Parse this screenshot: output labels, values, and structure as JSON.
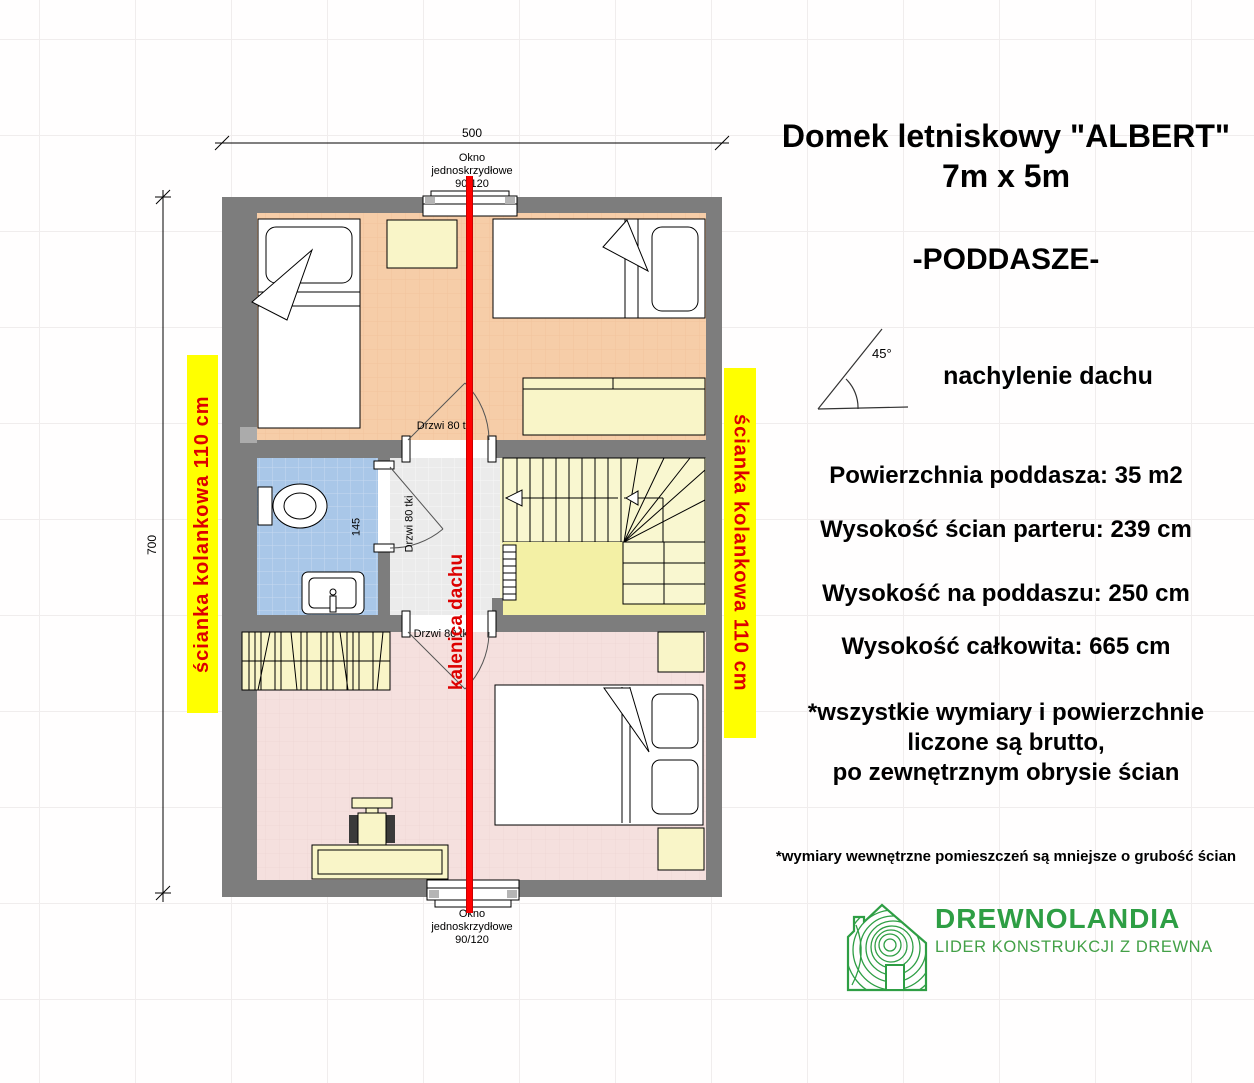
{
  "title": {
    "line1": "Domek letniskowy \"ALBERT\"",
    "line2": "7m x 5m",
    "floor": "-PODDASZE-"
  },
  "roof_pitch": {
    "angle": "45°",
    "label": "nachylenie dachu"
  },
  "specs": [
    "Powierzchnia poddasza: 35 m2",
    "Wysokość ścian parteru: 239 cm",
    "Wysokość na poddaszu: 250 cm",
    "Wysokość całkowita: 665 cm"
  ],
  "notes": {
    "line1": "*wszystkie wymiary i powierzchnie",
    "line2": "liczone są brutto,",
    "line3": "po zewnętrznym obrysie ścian",
    "small": "*wymiary wewnętrzne pomieszczeń są mniejsze o grubość ścian"
  },
  "logo": {
    "name": "DREWNOLANDIA",
    "tagline": "LIDER KONSTRUKCJI Z DREWNA"
  },
  "plan": {
    "dim_width": "500",
    "dim_height": "700",
    "dim_bath": "145",
    "window_label": {
      "l1": "Okno",
      "l2": "jednoskrzydłowe",
      "l3": "90/120"
    },
    "door_top": "Drzwi 80 tk",
    "door_mid": "Drzwi 80 tki",
    "door_bottom": "Drzwi 80 tki",
    "knee_wall": "ścianka kolankowa 110 cm",
    "ridge": "kalenica dachu"
  },
  "colors": {
    "highlight": "#FFFF00",
    "highlight_text": "#DD0000",
    "ridge_line": "#FF0000",
    "wall": "#7D7D7D",
    "bedroom_floor": "#F6CDA8",
    "bathroom_floor": "#A9C7E8",
    "bottom_room_floor": "#F5E0DE",
    "stairs": "#F9F7D0",
    "furniture": "#F9F5C8",
    "logo_green": "#2E9E44"
  }
}
